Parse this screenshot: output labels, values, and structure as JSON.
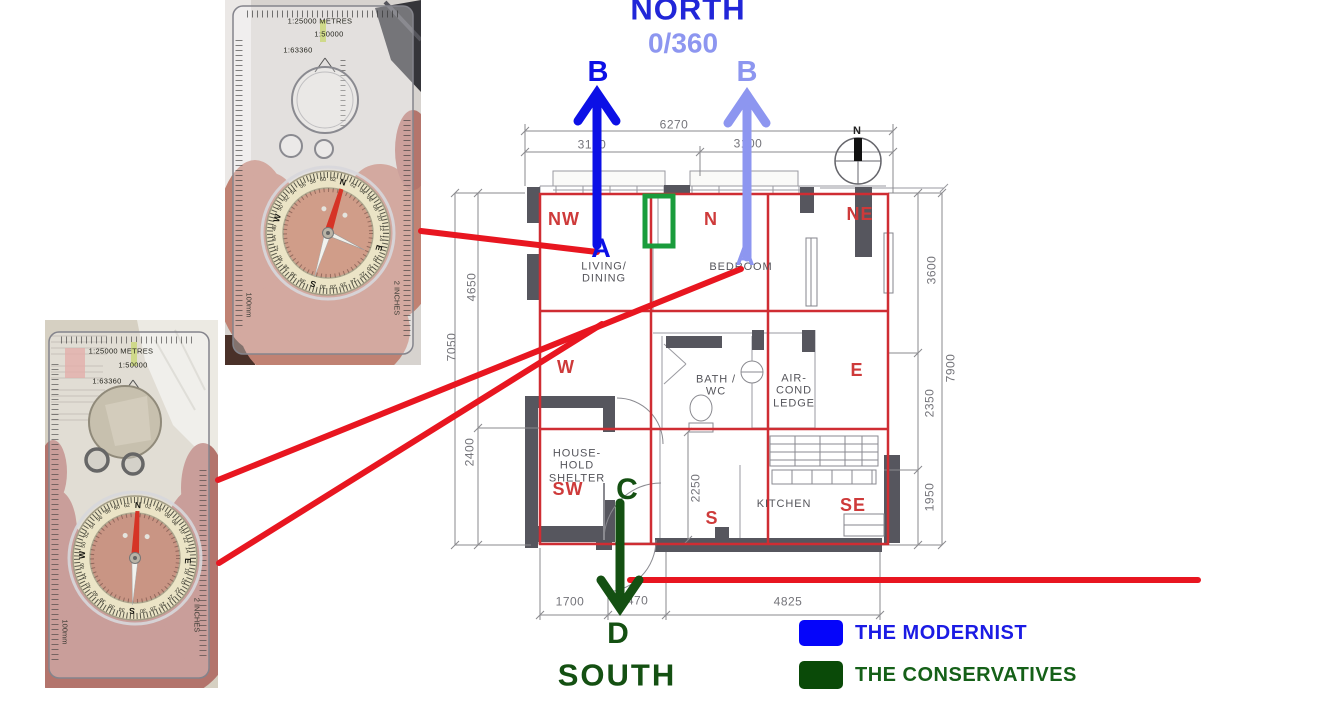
{
  "headings": {
    "north": "NORTH",
    "bearing": "0/360",
    "south": "SOUTH"
  },
  "markers": {
    "a": "A",
    "b": "B",
    "c": "C",
    "d": "D"
  },
  "legend": {
    "items": [
      {
        "label": "THE MODERNIST",
        "color": "#0505fa"
      },
      {
        "label": "THE CONSERVATIVES",
        "color": "#0a4a08"
      }
    ]
  },
  "colors": {
    "modernist_blue": "#0c10e6",
    "periwinkle": "#8d96f0",
    "conservative_green": "#145012",
    "annotation_red": "#e81620",
    "sector_red": "#ce3a3a",
    "highlight_green": "#1a9c3c"
  },
  "floor_plan": {
    "compass_rose_label": "N",
    "sectors": [
      "NW",
      "N",
      "NE",
      "W",
      "E",
      "SW",
      "S",
      "SE"
    ],
    "rooms": {
      "living": [
        "LIVING/",
        "DINING"
      ],
      "bedroom": [
        "BEDROOM"
      ],
      "bath": [
        "BATH /",
        "WC"
      ],
      "aircond": [
        "AIR-",
        "COND",
        "LEDGE"
      ],
      "shelter": [
        "HOUSE-",
        "HOLD",
        "SHELTER"
      ],
      "kitchen": [
        "KITCHEN"
      ]
    },
    "dimensions": {
      "top_total": "6270",
      "top_left": "3170",
      "top_right": "3100",
      "left_inner_top": "4650",
      "left_outer": "7050",
      "left_inner_bottom": "2400",
      "right_inner_top": "3600",
      "right_outer": "7900",
      "right_inner_mid": "2350",
      "right_inner_bottom": "1950",
      "corridor": "2250",
      "bottom_left": "1700",
      "bottom_mid": "1470",
      "bottom_right": "4825"
    }
  },
  "compasses": {
    "scales": [
      "1:25000 METRES",
      "1:50000",
      "1:63360"
    ],
    "units": [
      "100mm",
      "2 INCHES"
    ],
    "dial_ring": [
      "N",
      "02",
      "04",
      "06",
      "08",
      "10",
      "12",
      "14",
      "E",
      "18",
      "20",
      "22",
      "24",
      "26",
      "28",
      "30",
      "S",
      "34",
      "36",
      "38",
      "40",
      "42",
      "44",
      "46",
      "W",
      "50",
      "52",
      "54",
      "56",
      "58",
      "60",
      "62"
    ]
  }
}
